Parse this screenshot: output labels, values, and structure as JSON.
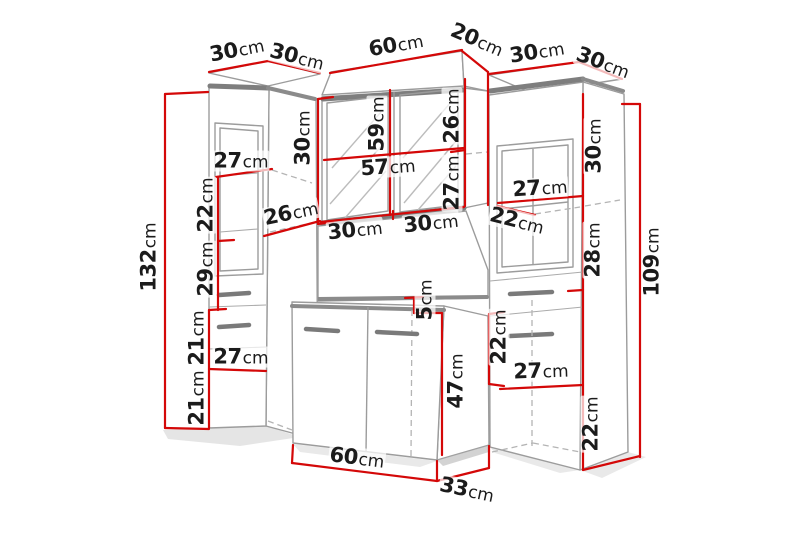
{
  "units": "cm",
  "colors": {
    "dimension_red": "#d40808",
    "outline_gray": "#9c9c9c",
    "band_gray": "#7e7e7e",
    "label_text": "#1b1b1b",
    "background": "#ffffff"
  },
  "labels": [
    {
      "part": "left-cabinet-top-width",
      "value": "30",
      "unit": "cm",
      "x": 237,
      "y": 50,
      "rot": -11
    },
    {
      "part": "left-cabinet-top-depth",
      "value": "30",
      "unit": "cm",
      "x": 297,
      "y": 57,
      "rot": 14
    },
    {
      "part": "mirror-cabinet-top-width",
      "value": "60",
      "unit": "cm",
      "x": 396,
      "y": 45,
      "rot": -10
    },
    {
      "part": "mirror-cabinet-top-depth",
      "value": "20",
      "unit": "cm",
      "x": 477,
      "y": 40,
      "rot": 23
    },
    {
      "part": "right-cabinet-top-width",
      "value": "30",
      "unit": "cm",
      "x": 537,
      "y": 52,
      "rot": -9
    },
    {
      "part": "right-cabinet-top-depth",
      "value": "30",
      "unit": "cm",
      "x": 603,
      "y": 63,
      "rot": 20
    },
    {
      "part": "left-cabinet-total-height",
      "value": "132",
      "unit": "cm",
      "x": 149,
      "y": 257,
      "rot": -90
    },
    {
      "part": "left-door-inner-width",
      "value": "27",
      "unit": "cm",
      "x": 241,
      "y": 161,
      "rot": 0
    },
    {
      "part": "left-shelf-height-upper",
      "value": "22",
      "unit": "cm",
      "x": 206,
      "y": 205,
      "rot": -90
    },
    {
      "part": "left-shelf-height-lower",
      "value": "29",
      "unit": "cm",
      "x": 206,
      "y": 269,
      "rot": -90
    },
    {
      "part": "left-to-mirror-gap",
      "value": "26",
      "unit": "cm",
      "x": 291,
      "y": 213,
      "rot": -12
    },
    {
      "part": "mirror-side-height",
      "value": "30",
      "unit": "cm",
      "x": 303,
      "y": 138,
      "rot": -90
    },
    {
      "part": "mirror-door-height",
      "value": "59",
      "unit": "cm",
      "x": 377,
      "y": 124,
      "rot": -90
    },
    {
      "part": "mirror-upper-section",
      "value": "26",
      "unit": "cm",
      "x": 452,
      "y": 116,
      "rot": -90
    },
    {
      "part": "mirror-inner-width",
      "value": "57",
      "unit": "cm",
      "x": 388,
      "y": 167,
      "rot": -4
    },
    {
      "part": "mirror-lower-section",
      "value": "27",
      "unit": "cm",
      "x": 452,
      "y": 183,
      "rot": -90
    },
    {
      "part": "mirror-door-width-left",
      "value": "30",
      "unit": "cm",
      "x": 355,
      "y": 230,
      "rot": -6
    },
    {
      "part": "mirror-door-width-right",
      "value": "30",
      "unit": "cm",
      "x": 431,
      "y": 223,
      "rot": -6
    },
    {
      "part": "right-door-inner-width",
      "value": "27",
      "unit": "cm",
      "x": 540,
      "y": 188,
      "rot": -4
    },
    {
      "part": "right-shelf-gap",
      "value": "22",
      "unit": "cm",
      "x": 517,
      "y": 221,
      "rot": 14
    },
    {
      "part": "right-upper-section",
      "value": "30",
      "unit": "cm",
      "x": 594,
      "y": 146,
      "rot": -90
    },
    {
      "part": "right-middle-section",
      "value": "28",
      "unit": "cm",
      "x": 593,
      "y": 250,
      "rot": -90
    },
    {
      "part": "right-cabinet-total-height",
      "value": "109",
      "unit": "cm",
      "x": 652,
      "y": 262,
      "rot": -90
    },
    {
      "part": "mirror-panel-gap",
      "value": "5",
      "unit": "cm",
      "x": 425,
      "y": 300,
      "rot": -90
    },
    {
      "part": "vanity-height",
      "value": "47",
      "unit": "cm",
      "x": 456,
      "y": 381,
      "rot": -90
    },
    {
      "part": "left-lower-section-upper",
      "value": "21",
      "unit": "cm",
      "x": 197,
      "y": 338,
      "rot": -90
    },
    {
      "part": "left-lower-door-width",
      "value": "27",
      "unit": "cm",
      "x": 241,
      "y": 357,
      "rot": 0
    },
    {
      "part": "left-lower-section-lower",
      "value": "21",
      "unit": "cm",
      "x": 197,
      "y": 398,
      "rot": -90
    },
    {
      "part": "vanity-width",
      "value": "60",
      "unit": "cm",
      "x": 357,
      "y": 458,
      "rot": 7
    },
    {
      "part": "vanity-depth",
      "value": "33",
      "unit": "cm",
      "x": 467,
      "y": 490,
      "rot": 12
    },
    {
      "part": "right-drawer-section",
      "value": "22",
      "unit": "cm",
      "x": 499,
      "y": 337,
      "rot": -90
    },
    {
      "part": "right-lower-door-width",
      "value": "27",
      "unit": "cm",
      "x": 541,
      "y": 371,
      "rot": -2
    },
    {
      "part": "right-plinth-section",
      "value": "22",
      "unit": "cm",
      "x": 591,
      "y": 424,
      "rot": -90
    }
  ]
}
